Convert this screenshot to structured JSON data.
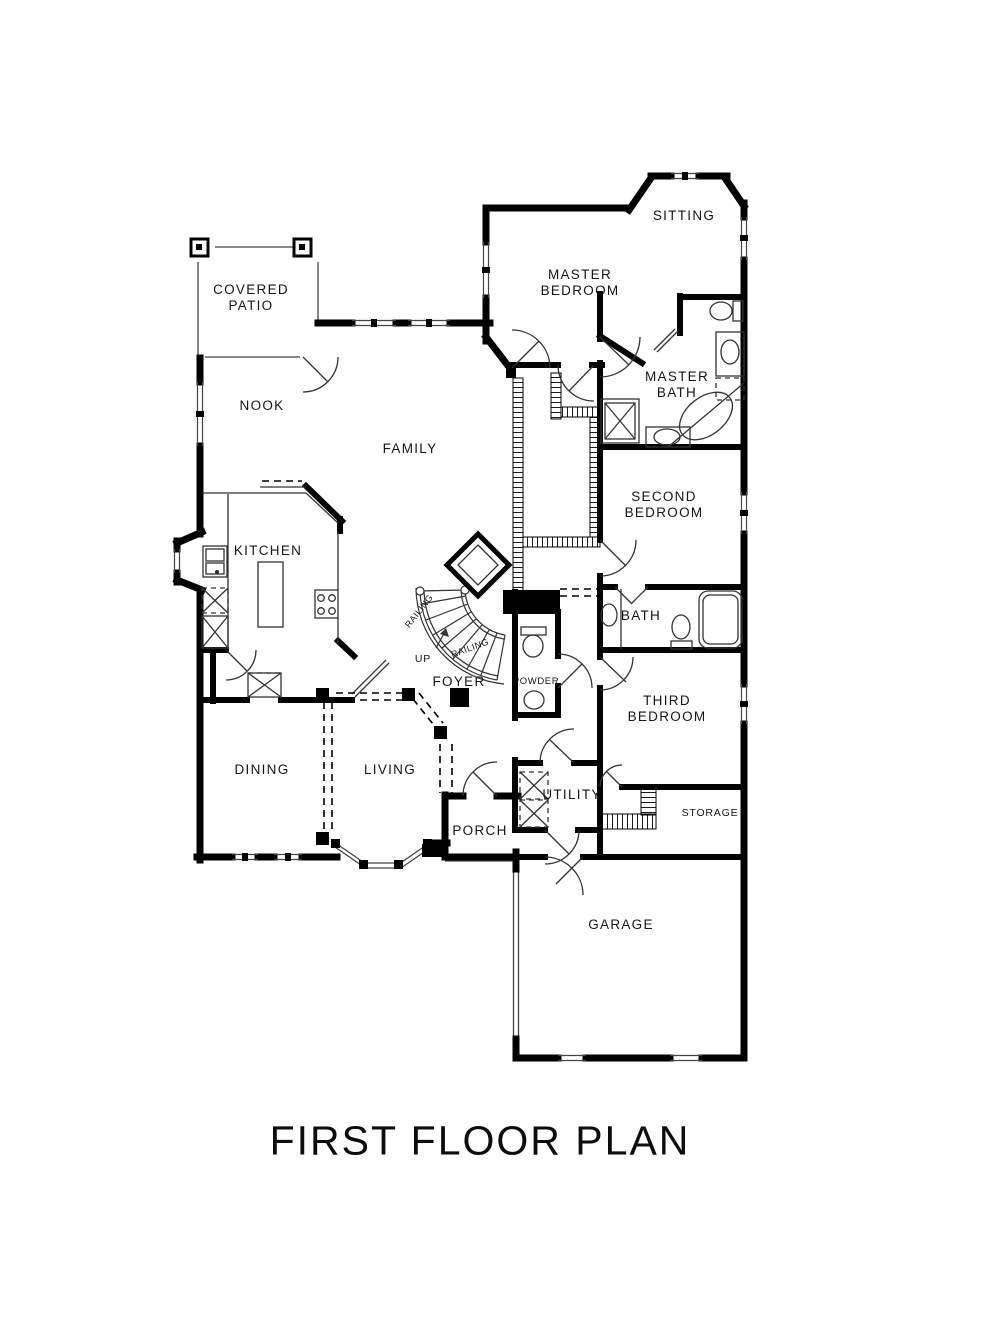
{
  "page": {
    "background": "#ffffff",
    "ink": "#000000"
  },
  "title": {
    "text": "FIRST FLOOR PLAN"
  },
  "rooms": {
    "covered_patio": {
      "line1": "COVERED",
      "line2": "PATIO"
    },
    "nook": {
      "label": "NOOK"
    },
    "family": {
      "label": "FAMILY"
    },
    "kitchen": {
      "label": "KITCHEN"
    },
    "master_bedroom": {
      "line1": "MASTER",
      "line2": "BEDROOM"
    },
    "sitting": {
      "label": "SITTING"
    },
    "master_bath": {
      "line1": "MASTER",
      "line2": "BATH"
    },
    "second_bedroom": {
      "line1": "SECOND",
      "line2": "BEDROOM"
    },
    "bath": {
      "label": "BATH"
    },
    "third_bedroom": {
      "line1": "THIRD",
      "line2": "BEDROOM"
    },
    "powder": {
      "label": "POWDER"
    },
    "foyer": {
      "label": "FOYER"
    },
    "dining": {
      "label": "DINING"
    },
    "living": {
      "label": "LIVING"
    },
    "utility": {
      "label": "UTILITY"
    },
    "storage": {
      "label": "STORAGE"
    },
    "porch": {
      "label": "PORCH"
    },
    "garage": {
      "label": "GARAGE"
    }
  },
  "stairs": {
    "railing_upper": "RAILING",
    "railing_lower": "RAILING",
    "up": "UP"
  }
}
